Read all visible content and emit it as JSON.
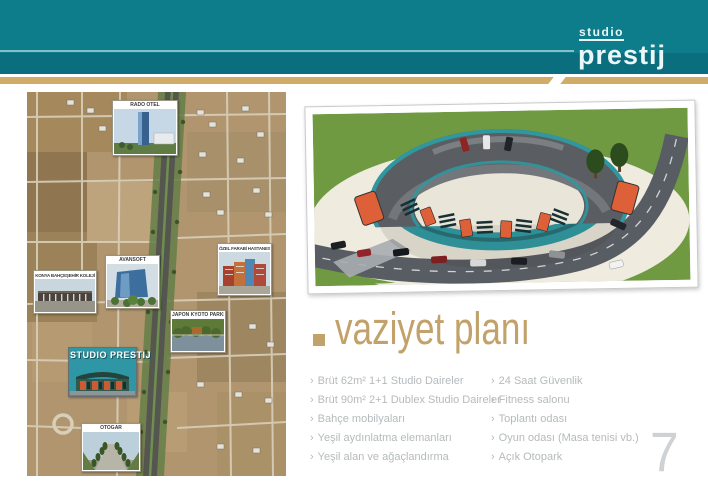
{
  "header": {
    "logo_top": "studio",
    "logo_bottom": "prestij"
  },
  "map_callouts": {
    "rado": "RADO OTEL",
    "kolej": "KONYA BAHÇEŞEHİR KOLEJİ",
    "avansoft": "AVANSOFT",
    "hastane": "ÖZEL FARABİ HASTANESİ",
    "park": "JAPON KYOTO PARKI",
    "prestij": "STUDIO PRESTIJ",
    "otogar": "OTOGAR"
  },
  "section": {
    "title": "vaziyet planı",
    "bullet": "›",
    "features_left": [
      "Brüt 62m² 1+1 Studio Daireler",
      "Brüt 90m² 2+1 Dublex Studio Daireler",
      "Bahçe mobilyaları",
      "Yeşil aydınlatma elemanları",
      "Yeşil alan ve ağaçlandırma"
    ],
    "features_right": [
      "24 Saat Güvenlik",
      "Fitness salonu",
      "Toplantı odası",
      "Oyun odası (Masa tenisi vb.)",
      "Açık Otopark"
    ]
  },
  "page_number": "7",
  "colors": {
    "teal": "#0d7d8c",
    "teal_dark": "#0b6e7e",
    "gold": "#d1ac69",
    "accent_tan": "#c2a26a",
    "text_gray": "#b5babc"
  }
}
